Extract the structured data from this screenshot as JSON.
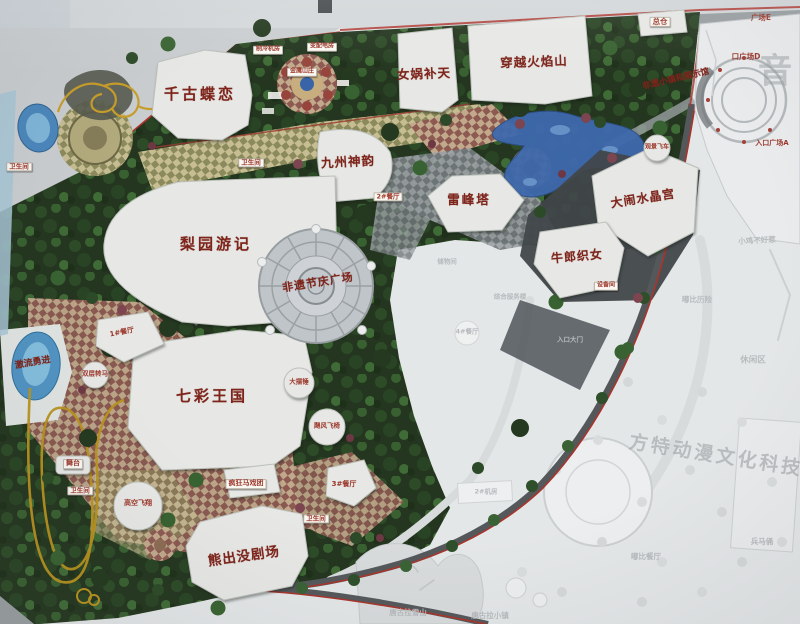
{
  "colors": {
    "label-red": "#7e241b",
    "tag-text": "#9c372b",
    "tag-bg": "#faf8f2",
    "faded-text": "#b7bbbd",
    "watermark-grey": "#9aa0a4",
    "map-green": "#24361f",
    "water-blue": "#3e69ad",
    "rail-red": "#ae332c"
  },
  "photo": {
    "watermark_diagonal": "方特动漫文化科技",
    "watermark_vertical": "音",
    "labels": [
      {
        "text": "千古蝶恋",
        "x": 200,
        "y": 94,
        "fs": 15,
        "ls": 3,
        "s": "bldg"
      },
      {
        "text": "女娲补天",
        "x": 424,
        "y": 74,
        "fs": 12.5,
        "rot": -2,
        "ls": 1,
        "s": "bldg"
      },
      {
        "text": "穿越火焰山",
        "x": 534,
        "y": 62,
        "fs": 12.5,
        "rot": -2,
        "ls": 1,
        "s": "bldg"
      },
      {
        "text": "九州神韵",
        "x": 348,
        "y": 162,
        "fs": 12.5,
        "rot": -3,
        "ls": 1,
        "s": "bldg"
      },
      {
        "text": "雷峰塔",
        "x": 469,
        "y": 200,
        "fs": 12.5,
        "ls": 2,
        "s": "bldg"
      },
      {
        "text": "大闹水晶宫",
        "x": 643,
        "y": 199,
        "fs": 12,
        "rot": -9,
        "ls": 1,
        "s": "bldg"
      },
      {
        "text": "牛郎织女",
        "x": 577,
        "y": 257,
        "fs": 12,
        "rot": -5,
        "ls": 1,
        "s": "bldg"
      },
      {
        "text": "梨园游记",
        "x": 216,
        "y": 244,
        "fs": 15,
        "ls": 3,
        "s": "bldg"
      },
      {
        "text": "非遗节庆广场",
        "x": 318,
        "y": 283,
        "fs": 11,
        "rot": -9,
        "ls": 1,
        "s": "bldg"
      },
      {
        "text": "七彩王国",
        "x": 212,
        "y": 396,
        "fs": 15,
        "ls": 3,
        "s": "bldg"
      },
      {
        "text": "熊出没剧场",
        "x": 244,
        "y": 557,
        "fs": 13.5,
        "rot": -8,
        "ls": 1,
        "s": "bldg"
      },
      {
        "text": "非遗小镇和展示馆",
        "x": 676,
        "y": 80,
        "fs": 8.5,
        "rot": -13,
        "s": "bldg"
      },
      {
        "text": "激流勇进",
        "x": 33,
        "y": 364,
        "fs": 9,
        "rot": -10,
        "s": "bldg"
      },
      {
        "text": "总仓",
        "x": 660,
        "y": 22,
        "fs": 7.5,
        "s": "tag"
      },
      {
        "text": "制冷机房",
        "x": 268,
        "y": 50,
        "fs": 6,
        "s": "tag"
      },
      {
        "text": "变配电房",
        "x": 322,
        "y": 47,
        "fs": 6,
        "s": "tag"
      },
      {
        "text": "金鹰山庄",
        "x": 302,
        "y": 72,
        "fs": 6,
        "s": "tag"
      },
      {
        "text": "卫生间",
        "x": 19,
        "y": 167,
        "fs": 6.5,
        "s": "tag"
      },
      {
        "text": "卫生间",
        "x": 251,
        "y": 163,
        "fs": 6.5,
        "s": "tag"
      },
      {
        "text": "卫生间",
        "x": 80,
        "y": 491,
        "fs": 6.5,
        "s": "tag"
      },
      {
        "text": "卫生间",
        "x": 316,
        "y": 519,
        "fs": 6.5,
        "s": "tag"
      },
      {
        "text": "2#餐厅",
        "x": 388,
        "y": 197,
        "fs": 6.5,
        "s": "tag"
      },
      {
        "text": "设备间",
        "x": 606,
        "y": 286,
        "fs": 6,
        "s": "tag"
      },
      {
        "text": "舞台",
        "x": 73,
        "y": 464,
        "fs": 7,
        "s": "tag"
      },
      {
        "text": "疯狂马戏团",
        "x": 246,
        "y": 484,
        "fs": 7,
        "s": "tag"
      },
      {
        "text": "3#餐厅",
        "x": 344,
        "y": 485,
        "fs": 7,
        "s": "plain"
      },
      {
        "text": "1#餐厅",
        "x": 122,
        "y": 333,
        "fs": 7,
        "rot": -11,
        "s": "plain"
      },
      {
        "text": "高空飞翔",
        "x": 138,
        "y": 504,
        "fs": 7,
        "s": "plain"
      },
      {
        "text": "双层转马",
        "x": 95,
        "y": 374,
        "fs": 6.5,
        "s": "plain"
      },
      {
        "text": "大摆锤",
        "x": 299,
        "y": 382,
        "fs": 6.5,
        "s": "plain"
      },
      {
        "text": "飓风飞椅",
        "x": 327,
        "y": 426,
        "fs": 6.5,
        "s": "plain"
      },
      {
        "text": "观景飞车",
        "x": 657,
        "y": 148,
        "fs": 6,
        "s": "plain"
      },
      {
        "text": "广场E",
        "x": 761,
        "y": 18,
        "fs": 7.5,
        "s": "plain"
      },
      {
        "text": "口广场D",
        "x": 746,
        "y": 57,
        "fs": 7.5,
        "s": "plain"
      },
      {
        "text": "入口广场A",
        "x": 772,
        "y": 144,
        "fs": 7,
        "s": "plain"
      },
      {
        "text": "储物间",
        "x": 447,
        "y": 262,
        "fs": 6.5,
        "s": "faded"
      },
      {
        "text": "综合服务楼",
        "x": 510,
        "y": 297,
        "fs": 6.5,
        "s": "faded"
      },
      {
        "text": "入口大门",
        "x": 570,
        "y": 340,
        "fs": 6.5,
        "s": "faded"
      },
      {
        "text": "4#餐厅",
        "x": 467,
        "y": 332,
        "fs": 6.5,
        "s": "faded"
      },
      {
        "text": "2#机房",
        "x": 486,
        "y": 492,
        "fs": 6.5,
        "s": "faded"
      },
      {
        "text": "小鸡不好惹",
        "x": 757,
        "y": 241,
        "fs": 7.5,
        "rot": -3,
        "s": "faded"
      },
      {
        "text": "嘟比历险",
        "x": 697,
        "y": 300,
        "fs": 7.5,
        "s": "faded"
      },
      {
        "text": "休闲区",
        "x": 753,
        "y": 361,
        "fs": 8.5,
        "s": "faded"
      },
      {
        "text": "兵马俑",
        "x": 762,
        "y": 542,
        "fs": 7.5,
        "s": "faded"
      },
      {
        "text": "嘟比餐厅",
        "x": 646,
        "y": 557,
        "fs": 7.5,
        "s": "faded"
      },
      {
        "text": "唐古拉雪山",
        "x": 408,
        "y": 613,
        "fs": 7.5,
        "s": "faded"
      },
      {
        "text": "唐古拉小镇",
        "x": 490,
        "y": 616,
        "fs": 7.5,
        "s": "faded"
      },
      {
        "text": "方特动漫文化科技",
        "x": 716,
        "y": 456,
        "fs": 19,
        "rot": 9,
        "ls": 3,
        "s": "wm"
      },
      {
        "text": "音",
        "x": 775,
        "y": 72,
        "fs": 34,
        "s": "wmv"
      }
    ]
  }
}
